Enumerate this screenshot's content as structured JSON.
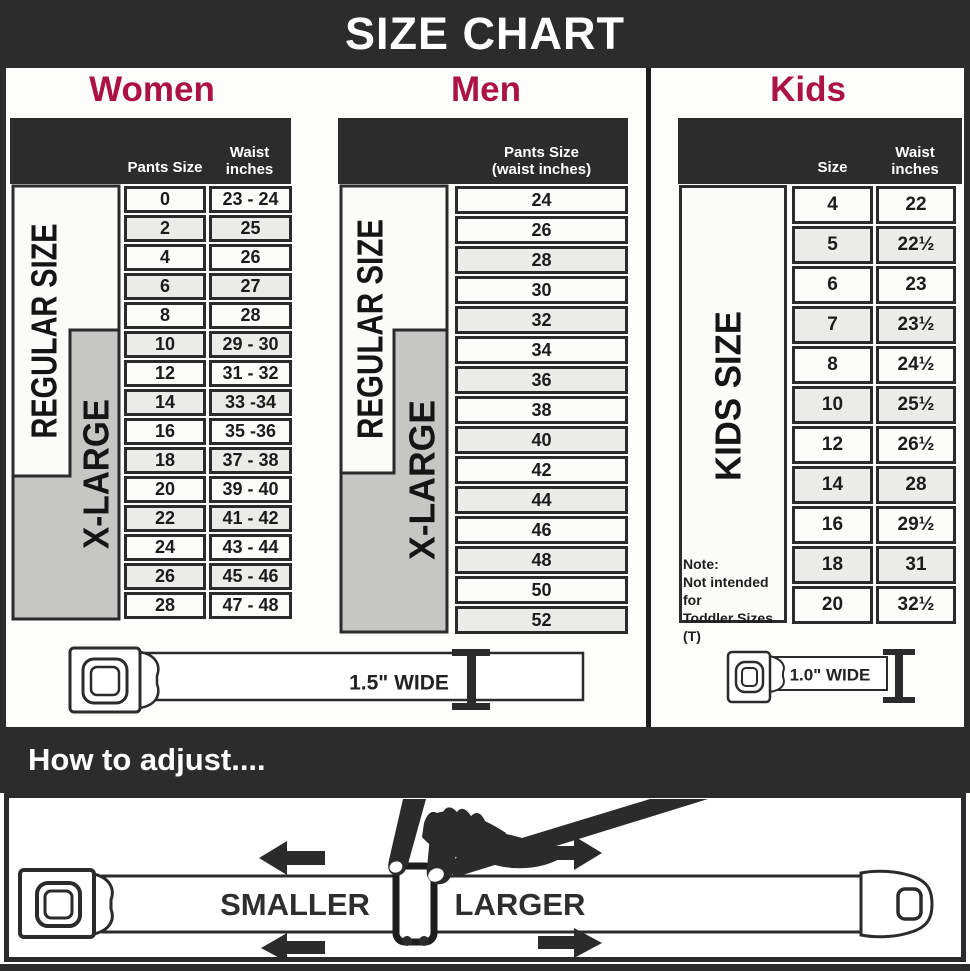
{
  "header": {
    "title": "SIZE CHART"
  },
  "women": {
    "title": "Women",
    "regular_size_label": "REGULAR SIZE",
    "xlarge_label": "X-LARGE",
    "col_pants_header": "Pants Size",
    "col_waist_header_line1": "Waist",
    "col_waist_header_line2": "inches",
    "rows": [
      {
        "size": "0",
        "waist": "23 - 24"
      },
      {
        "size": "2",
        "waist": "25"
      },
      {
        "size": "4",
        "waist": "26"
      },
      {
        "size": "6",
        "waist": "27"
      },
      {
        "size": "8",
        "waist": "28"
      },
      {
        "size": "10",
        "waist": "29 - 30"
      },
      {
        "size": "12",
        "waist": "31 - 32"
      },
      {
        "size": "14",
        "waist": "33 -34"
      },
      {
        "size": "16",
        "waist": "35 -36"
      },
      {
        "size": "18",
        "waist": "37 - 38"
      },
      {
        "size": "20",
        "waist": "39 - 40"
      },
      {
        "size": "22",
        "waist": "41 - 42"
      },
      {
        "size": "24",
        "waist": "43 - 44"
      },
      {
        "size": "26",
        "waist": "45 - 46"
      },
      {
        "size": "28",
        "waist": "47 - 48"
      }
    ]
  },
  "men": {
    "title": "Men",
    "regular_size_label": "REGULAR SIZE",
    "xlarge_label": "X-LARGE",
    "col_header_line1": "Pants Size",
    "col_header_line2": "(waist inches)",
    "rows": [
      "24",
      "26",
      "28",
      "30",
      "32",
      "34",
      "36",
      "38",
      "40",
      "42",
      "44",
      "46",
      "48",
      "50",
      "52"
    ]
  },
  "kids": {
    "title": "Kids",
    "side_label": "KIDS SIZE",
    "col_size_header": "Size",
    "col_waist_header_line1": "Waist",
    "col_waist_header_line2": "inches",
    "note_line1": "Note:",
    "note_line2": "Not intended for",
    "note_line3": "Toddler Sizes (T)",
    "rows": [
      {
        "size": "4",
        "waist": "22"
      },
      {
        "size": "5",
        "waist": "22½"
      },
      {
        "size": "6",
        "waist": "23"
      },
      {
        "size": "7",
        "waist": "23½"
      },
      {
        "size": "8",
        "waist": "24½"
      },
      {
        "size": "10",
        "waist": "25½"
      },
      {
        "size": "12",
        "waist": "26½"
      },
      {
        "size": "14",
        "waist": "28"
      },
      {
        "size": "16",
        "waist": "29½"
      },
      {
        "size": "18",
        "waist": "31"
      },
      {
        "size": "20",
        "waist": "32½"
      }
    ]
  },
  "belts": {
    "adult_width_label": "1.5\" WIDE",
    "kids_width_label": "1.0\" WIDE"
  },
  "adjust": {
    "heading": "How to adjust....",
    "smaller_label": "SMALLER",
    "larger_label": "LARGER"
  },
  "colors": {
    "accent": "#ac1243",
    "dark": "#2d2c2c",
    "row_alt": "#ebebe9",
    "label_gray": "#c6c6c4"
  }
}
